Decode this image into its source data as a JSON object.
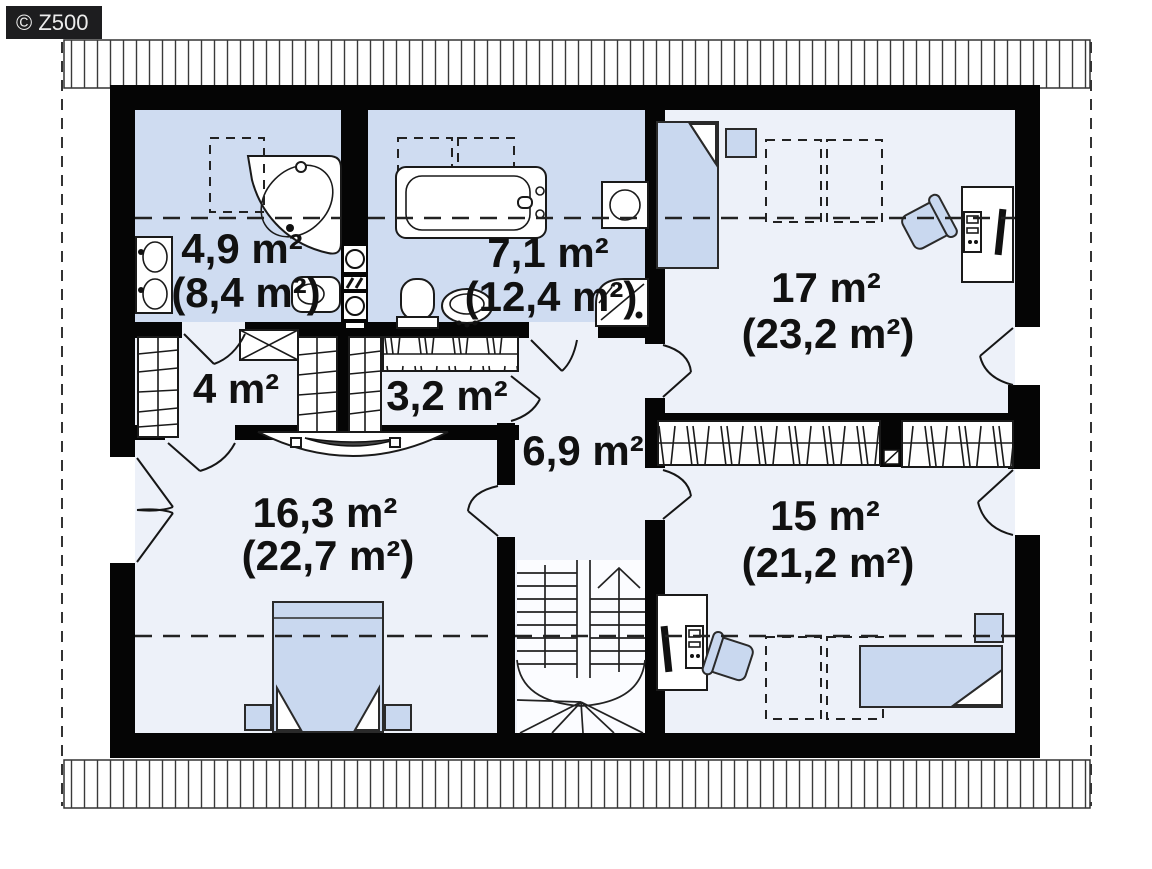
{
  "watermark": {
    "label": "© Z500"
  },
  "plan": {
    "type": "floor-plan",
    "floor": "attic",
    "rooms": {
      "bath_small": {
        "area": "4,9 m²",
        "total": "(8,4 m²)"
      },
      "bath_large": {
        "area": "7,1 m²",
        "total": "(12,4 m²)"
      },
      "bedroom_top_right": {
        "area": "17 m²",
        "total": "(23,2 m²)"
      },
      "closet_small": {
        "area": "4 m²"
      },
      "closet_long": {
        "area": "3,2 m²"
      },
      "hallway": {
        "area": "6,9 m²"
      },
      "bedroom_left": {
        "area": "16,3 m²",
        "total": "(22,7 m²)"
      },
      "bedroom_bottom_right": {
        "area": "15 m²",
        "total": "(21,2 m²)"
      }
    },
    "colors": {
      "bathroom_floor": "#cfdcf1",
      "room_floor": "#edf1f9",
      "furniture": "#c9d8ef",
      "wall": "#050505",
      "watermark_bg": "#1d1d1f"
    }
  }
}
